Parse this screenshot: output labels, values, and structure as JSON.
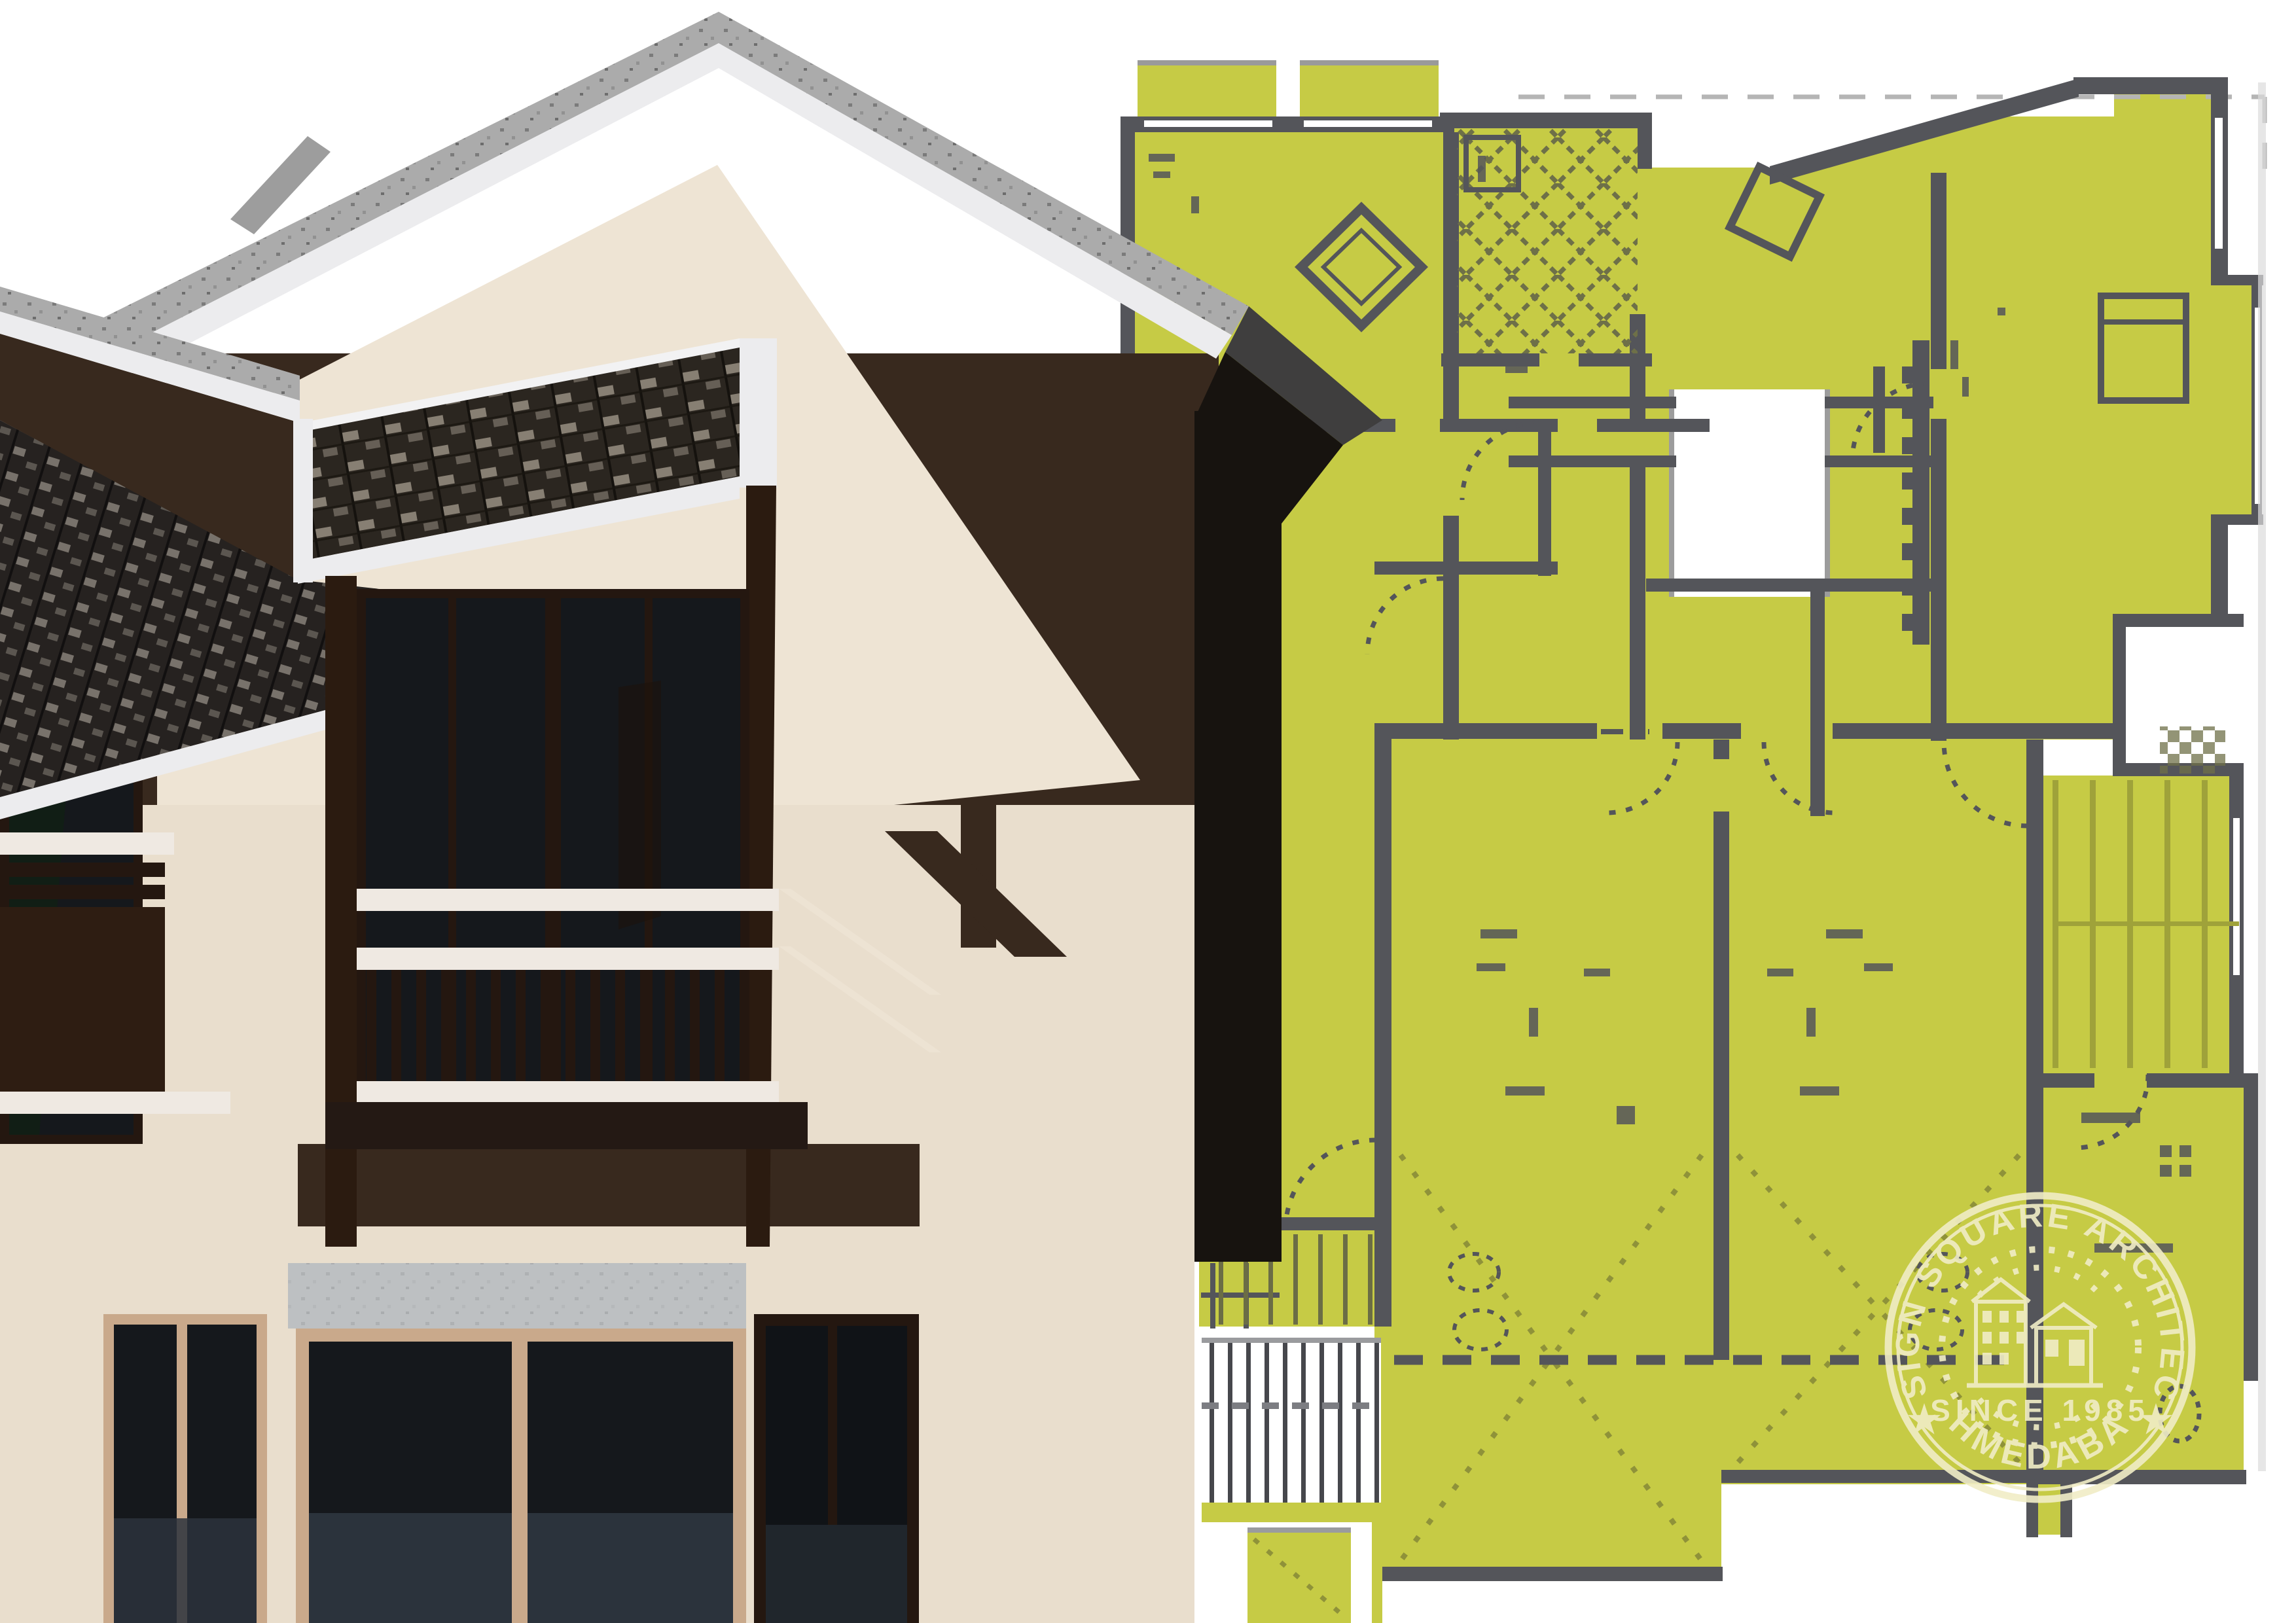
{
  "stamp": {
    "arc_top": "DESIGN SQUARE ARCHITECTS",
    "center_line": "SINCE 1985",
    "arc_bottom": "AHMEDABAD",
    "star": "★"
  },
  "colors": {
    "plan_fill": "#c6cb45",
    "plan_fill_deep": "#b9bf3e",
    "wall": "#54555a",
    "wall_soft": "#77794f",
    "olive_dash": "#8f9239",
    "tile": "#6e7048",
    "roof_gray": "#ababab",
    "roof_speck": "#6f6f6f",
    "fascia": "#ececee",
    "gable_brown": "#38291e",
    "cream": "#e9decd",
    "cream_lit": "#eee4d4",
    "post": "#2b1b10",
    "frame_dark": "#241710",
    "glass": "#15181c",
    "glass_floor": "#2b333c",
    "glass_green": "#0e2511",
    "tan": "#c9a98b",
    "lintel": "#c3c7ca",
    "black_side": "#17130f",
    "rail_white": "#efe9e2",
    "shingle_dark": "#2b2620",
    "shingle_light": "#a59c8e",
    "slat": "#46474c",
    "tread": "#6b6d45",
    "stamp": "#f1edc6"
  }
}
